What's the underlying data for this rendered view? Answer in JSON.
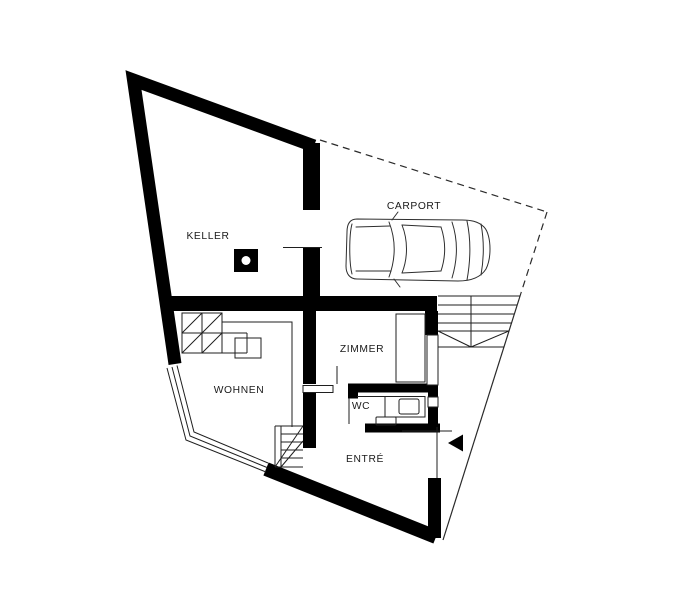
{
  "plan": {
    "type": "architectural floor plan",
    "labels": {
      "keller": "KELLER",
      "carport": "CARPORT",
      "zimmer": "ZIMMER",
      "wohnen": "WOHNEN",
      "wc": "WC",
      "entre": "ENTRÉ"
    },
    "colors": {
      "walls": "#000000",
      "lines": "#1f1f1f",
      "text": "#1a1a1a",
      "background": "#ffffff"
    },
    "symbols": [
      "car-icon",
      "entrance-arrow-icon",
      "column-icon",
      "stair-hatch",
      "property-boundary-dashed"
    ]
  }
}
